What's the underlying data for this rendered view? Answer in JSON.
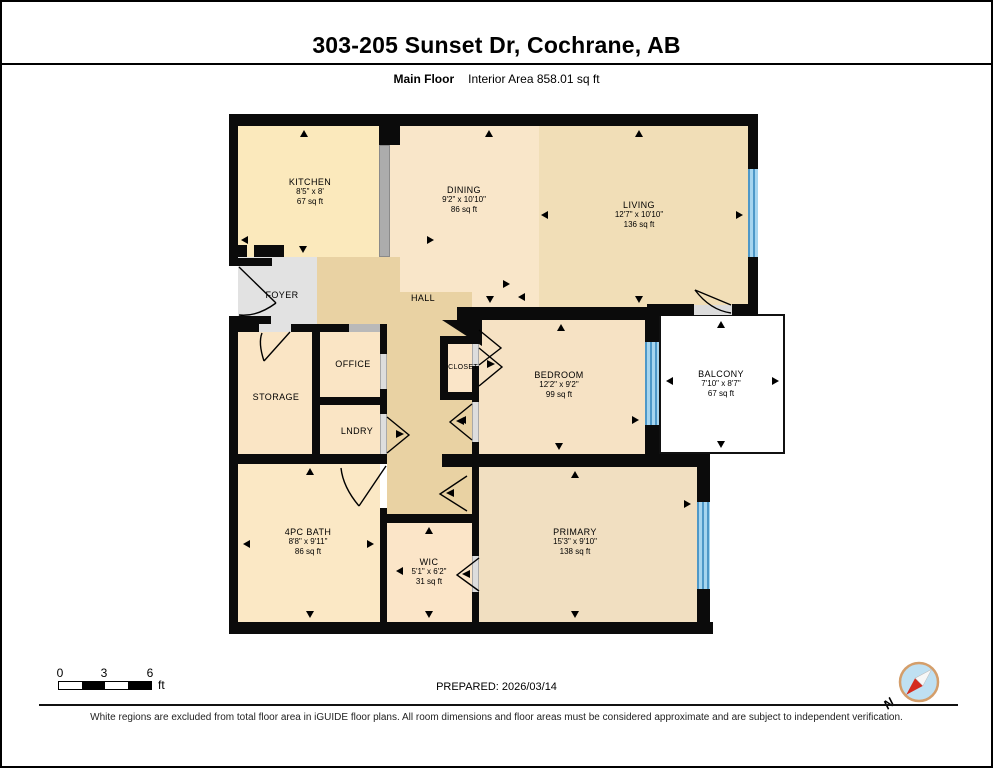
{
  "header": {
    "title": "303-205 Sunset Dr, Cochrane, AB",
    "floor_label": "Main Floor",
    "area_label": "Interior Area 858.01 sq ft"
  },
  "rooms": [
    {
      "name": "KITCHEN",
      "dims": "8'5\" x 8'",
      "area": "67 sq ft"
    },
    {
      "name": "DINING",
      "dims": "9'2\" x 10'10\"",
      "area": "86 sq ft"
    },
    {
      "name": "LIVING",
      "dims": "12'7\" x 10'10\"",
      "area": "136 sq ft"
    },
    {
      "name": "FOYER"
    },
    {
      "name": "HALL"
    },
    {
      "name": "OFFICE"
    },
    {
      "name": "STORAGE"
    },
    {
      "name": "CLOSET"
    },
    {
      "name": "BEDROOM",
      "dims": "12'2\" x 9'2\"",
      "area": "99 sq ft"
    },
    {
      "name": "BALCONY",
      "dims": "7'10\" x 8'7\"",
      "area": "67 sq ft"
    },
    {
      "name": "LNDRY"
    },
    {
      "name": "4PC BATH",
      "dims": "8'8\" x 9'11\"",
      "area": "86 sq ft"
    },
    {
      "name": "WIC",
      "dims": "5'1\" x 6'2\"",
      "area": "31 sq ft"
    },
    {
      "name": "PRIMARY",
      "dims": "15'3\" x 9'10\"",
      "area": "138 sq ft"
    }
  ],
  "scale": {
    "ticks": [
      "0",
      "3",
      "6"
    ],
    "unit": "ft"
  },
  "footer": {
    "prepared": "PREPARED: 2026/03/14",
    "disclaimer": "White regions are excluded from total floor area in iGUIDE floor plans. All room dimensions and floor areas must be considered approximate and are subject to independent verification.",
    "compass_label": "N"
  },
  "colors": {
    "wall": "#0b0b0b",
    "window_blue": "#7fc0e8",
    "kitchen": "#fbe9bc",
    "dining": "#f9e6c9",
    "living": "#f1deb7",
    "hall": "#e9d2a3",
    "foyer_gray": "#e2e2e2",
    "warm_room": "#fae5c5",
    "bedroom": "#f6e2c4",
    "primary": "#f1dfc1",
    "balcony": "#ffffff",
    "compass_red": "#d42a1d",
    "compass_face": "#bfe0f2"
  }
}
